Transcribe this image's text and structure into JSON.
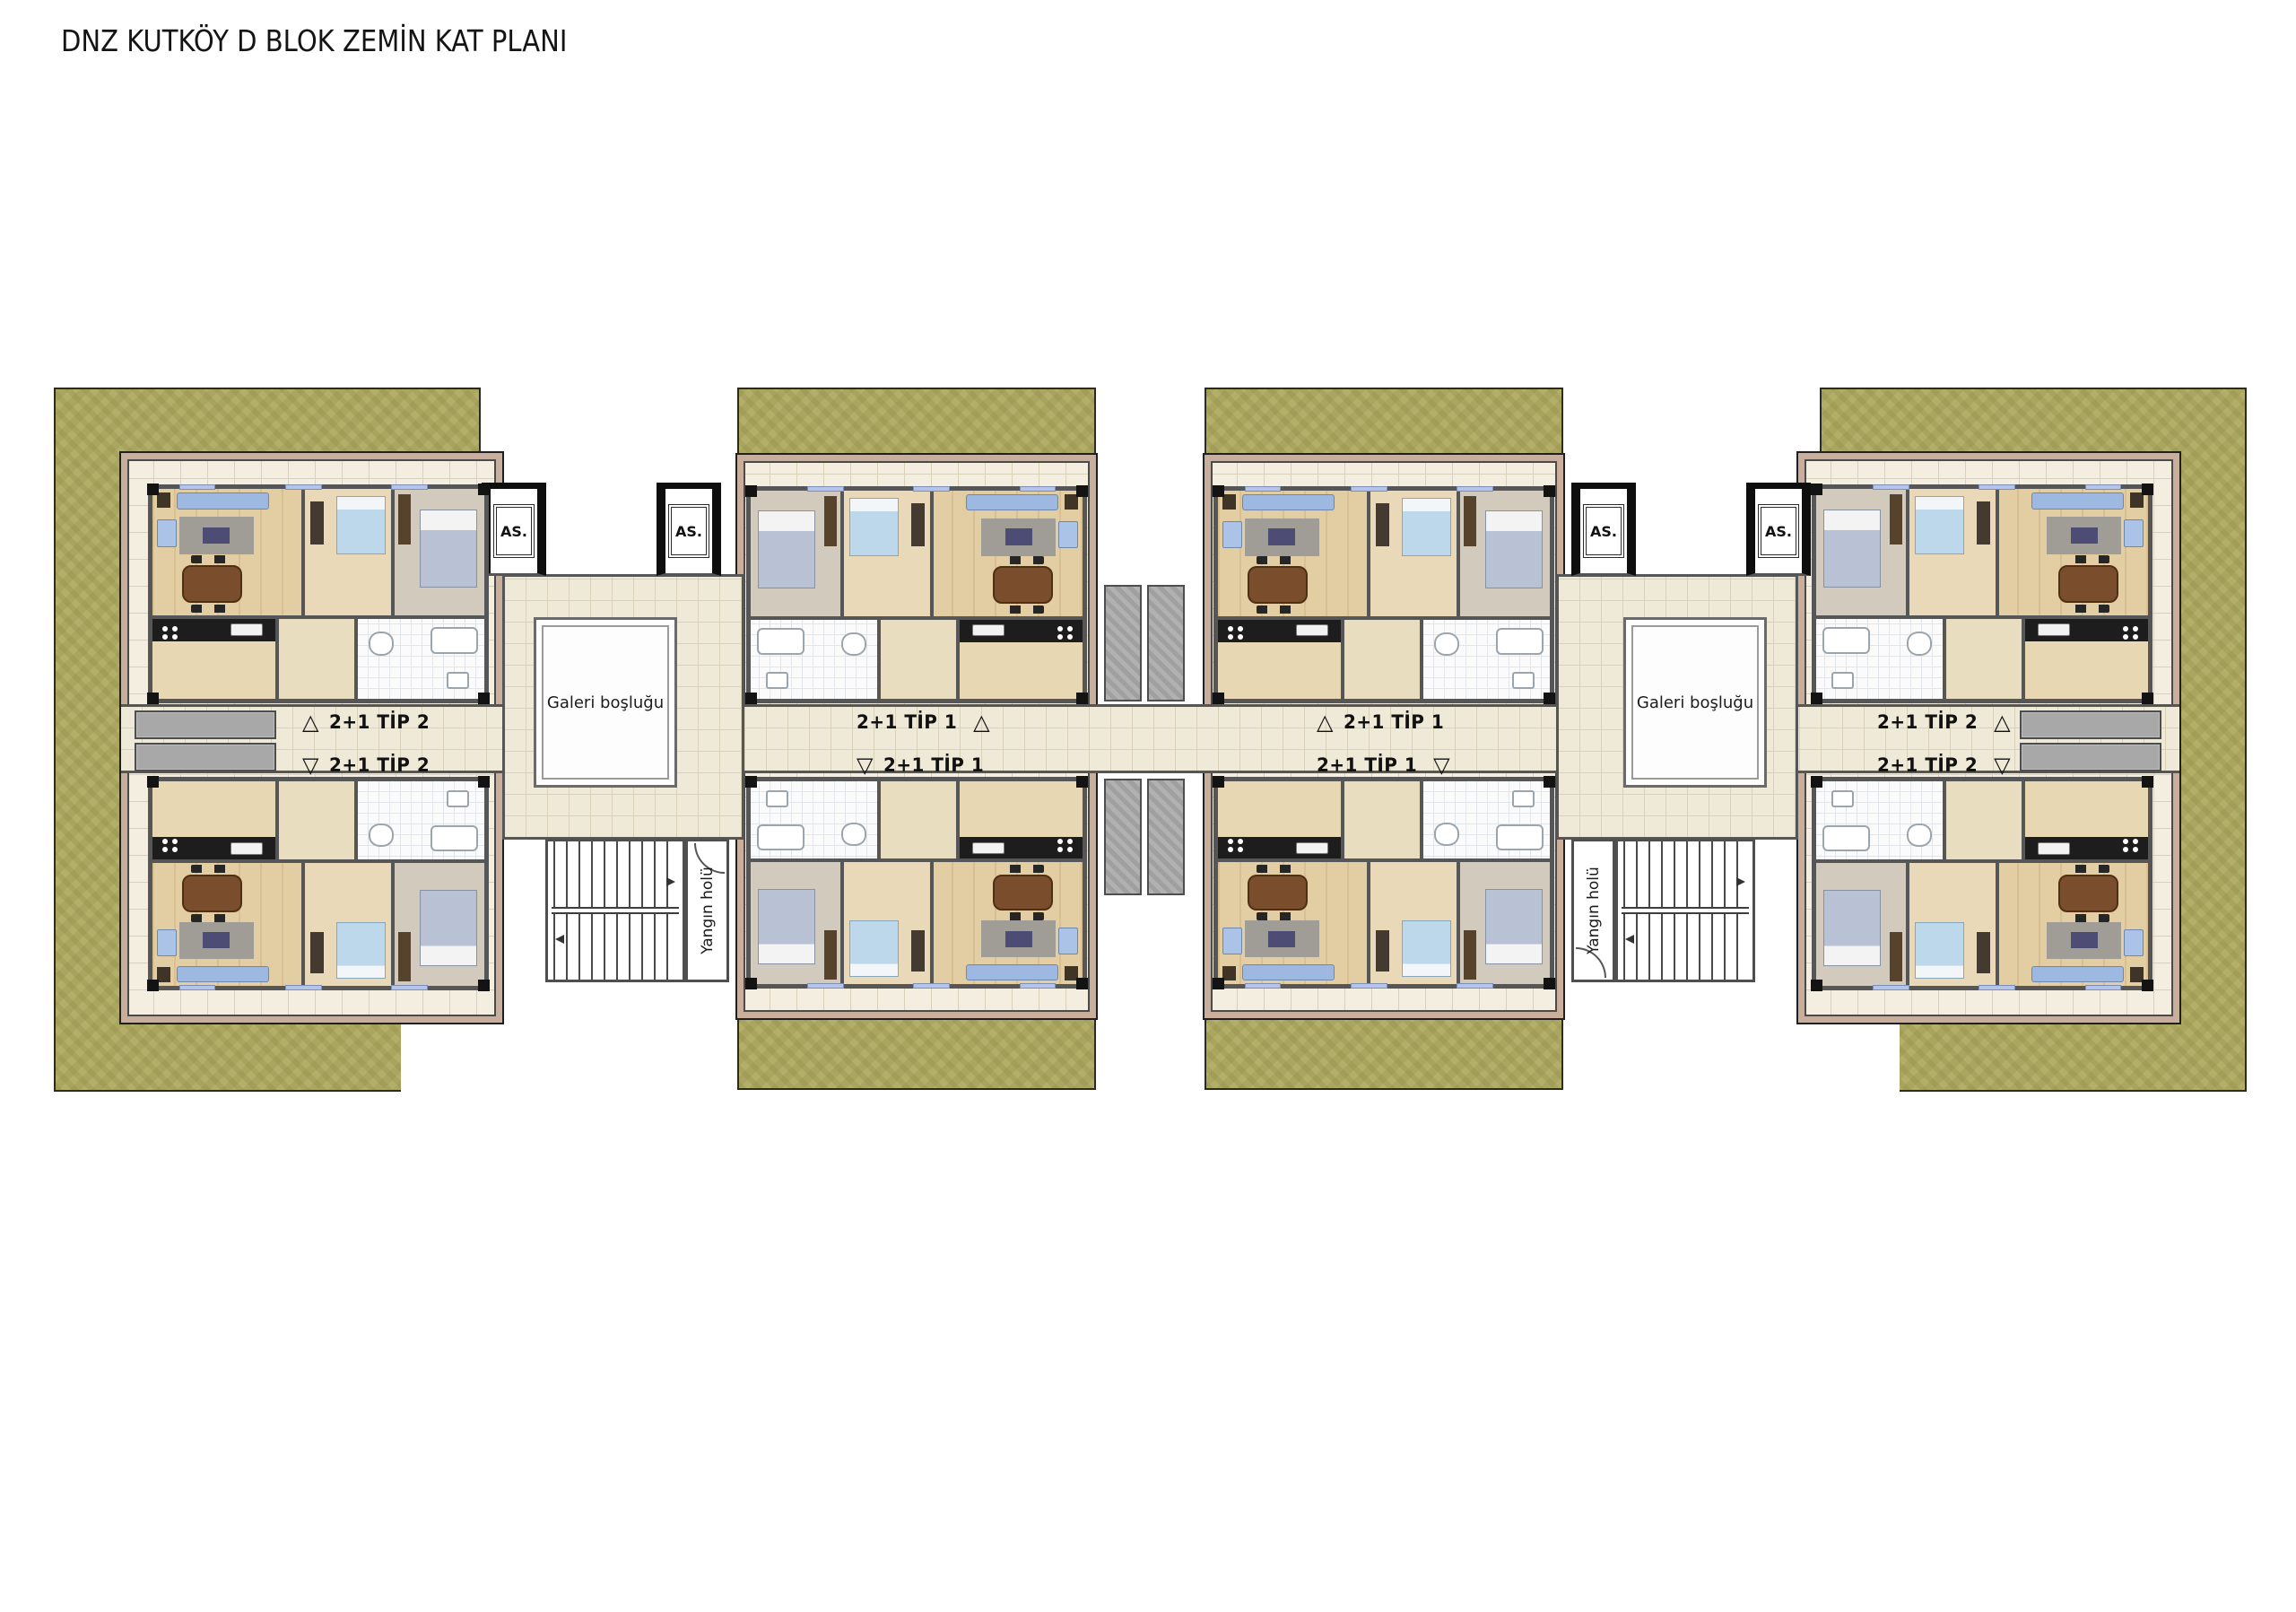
{
  "title": "DNZ KUTKÖY D BLOK ZEMİN KAT PLANI",
  "labels": {
    "elevator": "AS.",
    "gallery": "Galeri boşluğu",
    "fire_hall": "Yangın holü"
  },
  "unit_labels": [
    {
      "id": "left-wing-upper",
      "arrow": "△",
      "text": "2+1 TİP 2"
    },
    {
      "id": "left-wing-lower",
      "arrow": "▽",
      "text": "2+1 TİP 2"
    },
    {
      "id": "mid-left-wing-upper",
      "arrow": "△",
      "text": "2+1 TİP 1"
    },
    {
      "id": "mid-left-wing-lower",
      "arrow": "▽",
      "text": "2+1 TİP 1"
    },
    {
      "id": "mid-right-wing-upper",
      "arrow": "△",
      "text": "2+1 TİP 1"
    },
    {
      "id": "mid-right-wing-lower",
      "arrow": "▽",
      "text": "2+1 TİP 1"
    },
    {
      "id": "right-wing-upper",
      "arrow": "△",
      "text": "2+1 TİP 2"
    },
    {
      "id": "right-wing-lower",
      "arrow": "▽",
      "text": "2+1 TİP 2"
    }
  ],
  "colors": {
    "grass": "#aaa660",
    "grass_line": "#2b2b20",
    "terrace_tile": "#f3eee0",
    "corridor_tile": "#efe9d8",
    "tile_line": "#d9d2ba",
    "tan": "#c9ae9c",
    "wall": "#565656",
    "wood": "#dcc193",
    "wood_light": "#e3cda2",
    "rug": "#a09c96",
    "sofa": "#9db9e2",
    "table_brown": "#7a4e2c",
    "counter": "#1d1d1d",
    "bath_line": "#e2e6ea",
    "balcony": "#a8a8a8"
  }
}
